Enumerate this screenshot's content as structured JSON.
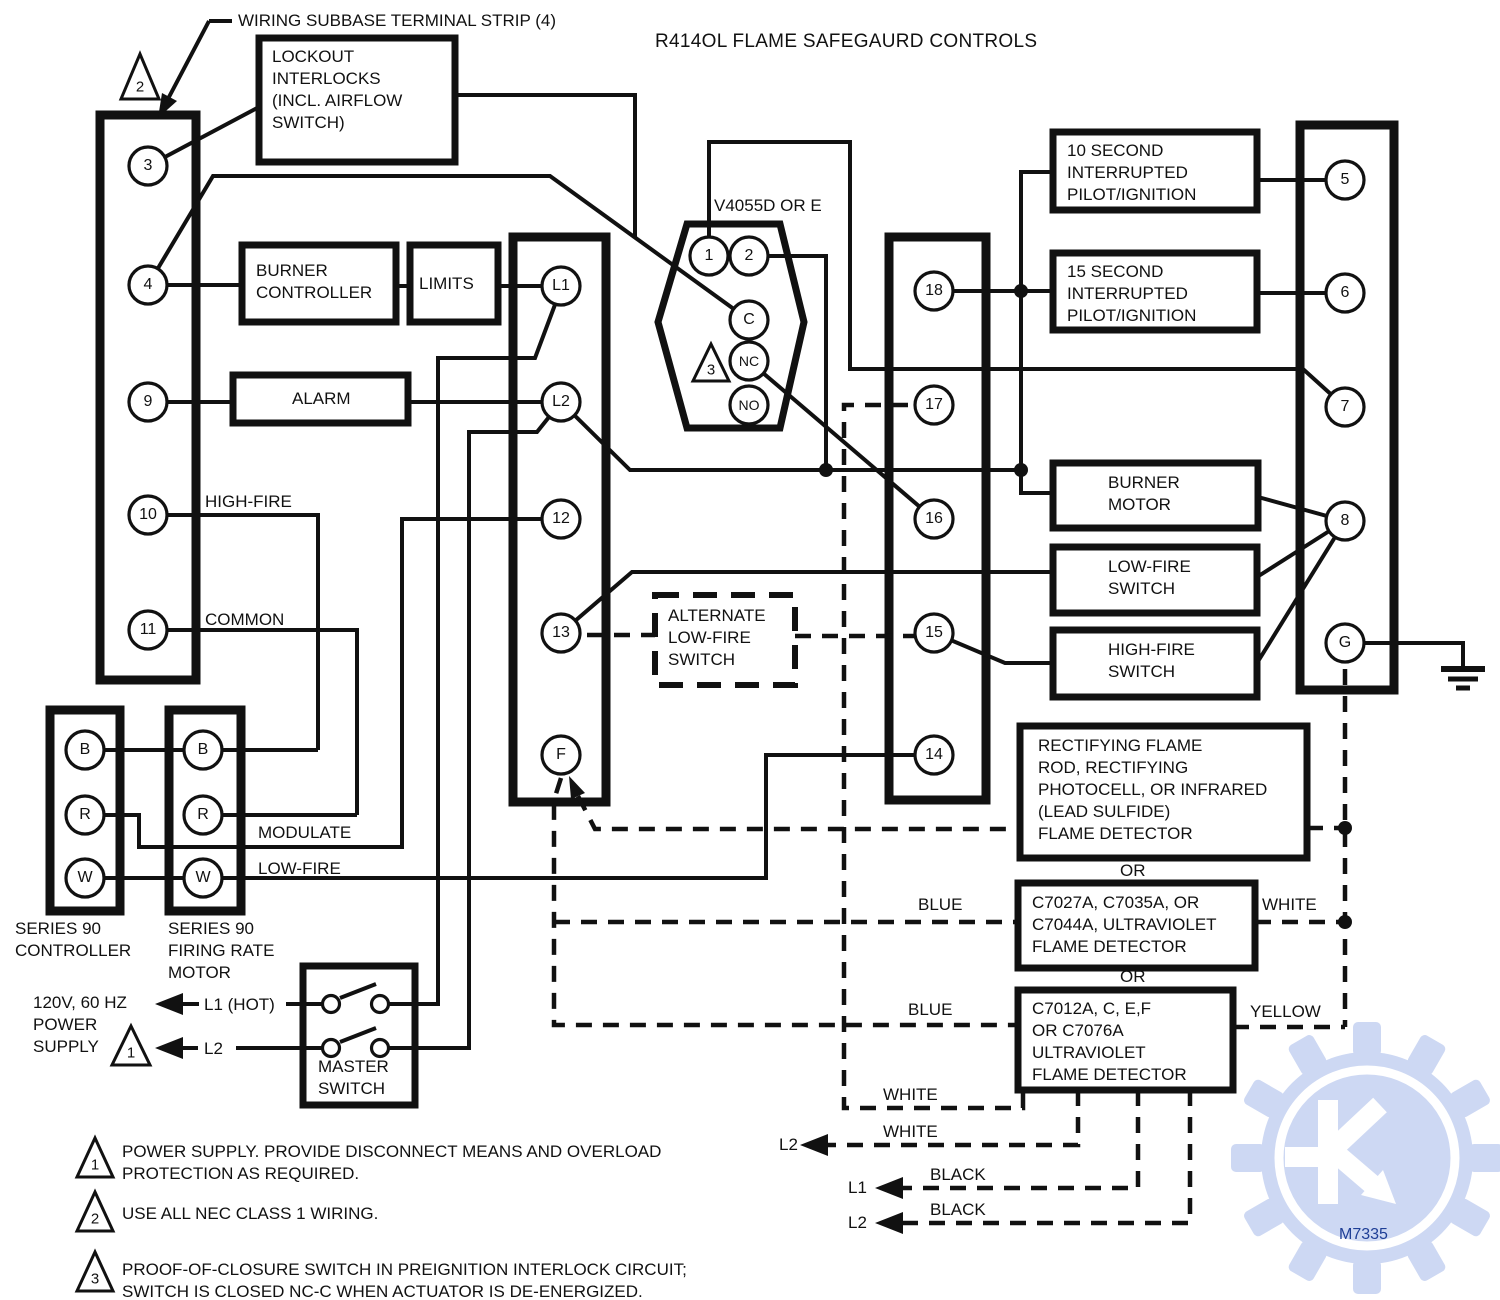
{
  "title": "R414OL FLAME SAFEGAURD CONTROLS",
  "labels": {
    "wsts": "WIRING SUBBASE TERMINAL STRIP (4)",
    "high_fire": "HIGH-FIRE",
    "common": "COMMON",
    "modulate": "MODULATE",
    "low_fire": "LOW-FIRE",
    "or_1": "OR",
    "or_2": "OR",
    "blue_1": "BLUE",
    "white_1": "WHITE",
    "blue_2": "BLUE",
    "yellow": "YELLOW",
    "white_2": "WHITE",
    "white_3": "WHITE",
    "black_1": "BLACK",
    "black_2": "BLACK",
    "l2_a": "L2",
    "l1_a": "L1",
    "l2_b": "L2"
  },
  "boxes": {
    "lockout": "LOCKOUT\nINTERLOCKS\n(INCL. AIRFLOW\nSWITCH)",
    "burner_controller": "BURNER\nCONTROLLER",
    "limits": "LIMITS",
    "alarm": "ALARM",
    "pilot10": "10 SECOND\nINTERRUPTED\nPILOT/IGNITION",
    "pilot15": "15 SECOND\nINTERRUPTED\nPILOT/IGNITION",
    "burner_motor": "BURNER\nMOTOR",
    "low_fire_switch": "LOW-FIRE\nSWITCH",
    "high_fire_switch": "HIGH-FIRE\nSWITCH",
    "alternate": "ALTERNATE\nLOW-FIRE\nSWITCH",
    "rectifying": "RECTIFYING FLAME\nROD, RECTIFYING\nPHOTOCELL, OR INFRARED\n(LEAD SULFIDE)\nFLAME DETECTOR",
    "c7027": "C7027A, C7035A, OR\nC7044A, ULTRAVIOLET\nFLAME DETECTOR",
    "c7012": "C7012A, C, E,F\nOR C7076A\nULTRAVIOLET\nFLAME DETECTOR"
  },
  "valve": {
    "name": "V4055D OR E",
    "terminals": [
      "1",
      "2",
      "C",
      "NC",
      "NO"
    ],
    "callout": "3"
  },
  "strips": {
    "subbase": [
      "3",
      "4",
      "9",
      "10",
      "11"
    ],
    "left": [
      "L1",
      "L2",
      "12",
      "13",
      "F"
    ],
    "right": [
      "18",
      "17",
      "16",
      "15",
      "14"
    ],
    "load": [
      "5",
      "6",
      "7",
      "8",
      "G"
    ]
  },
  "series90": {
    "controller": {
      "label": "SERIES 90\nCONTROLLER",
      "terminals": [
        "B",
        "R",
        "W"
      ]
    },
    "motor": {
      "label": "SERIES 90\nFIRING RATE\nMOTOR",
      "terminals": [
        "B",
        "R",
        "W"
      ]
    }
  },
  "power": {
    "label": "120V, 60 HZ\nPOWER\nSUPPLY",
    "l1": "L1 (HOT)",
    "l2": "L2",
    "callout": "1"
  },
  "master_switch": {
    "label": "MASTER\nSWITCH"
  },
  "callout_top": "2",
  "notes": [
    {
      "ref": "1",
      "text": "POWER SUPPLY. PROVIDE DISCONNECT MEANS AND OVERLOAD\nPROTECTION AS REQUIRED."
    },
    {
      "ref": "2",
      "text": "USE ALL NEC CLASS 1 WIRING."
    },
    {
      "ref": "3",
      "text": "PROOF-OF-CLOSURE SWITCH IN PREIGNITION INTERLOCK CIRCUIT;\nSWITCH IS CLOSED NC-C WHEN ACTUATOR IS DE-ENERGIZED."
    }
  ],
  "watermark": {
    "code": "M7335",
    "gear_color": "#cdd8f3",
    "code_color": "#1e3e96"
  },
  "ink": "#111111"
}
